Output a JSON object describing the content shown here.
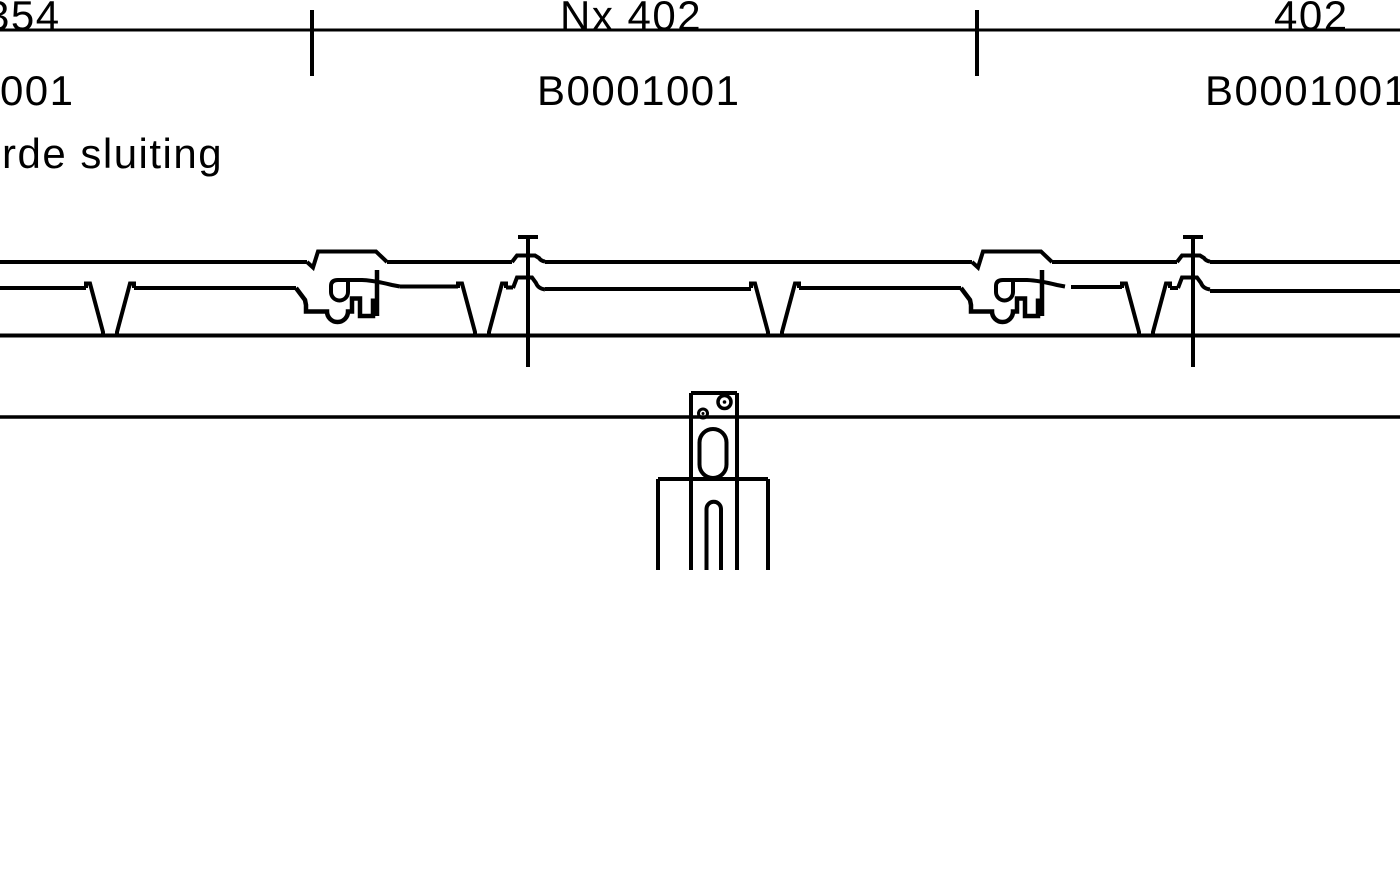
{
  "page": {
    "background": "#ffffff",
    "line_color": "#000000"
  },
  "dimension_row": {
    "left_value": "354",
    "middle_value": "Nx 402",
    "right_value": "402"
  },
  "part_number_row": {
    "left_value": "B0001001",
    "middle_value": "B0001001",
    "right_value": "B0001001"
  },
  "annotation": {
    "closure_note": "rde sluiting"
  }
}
